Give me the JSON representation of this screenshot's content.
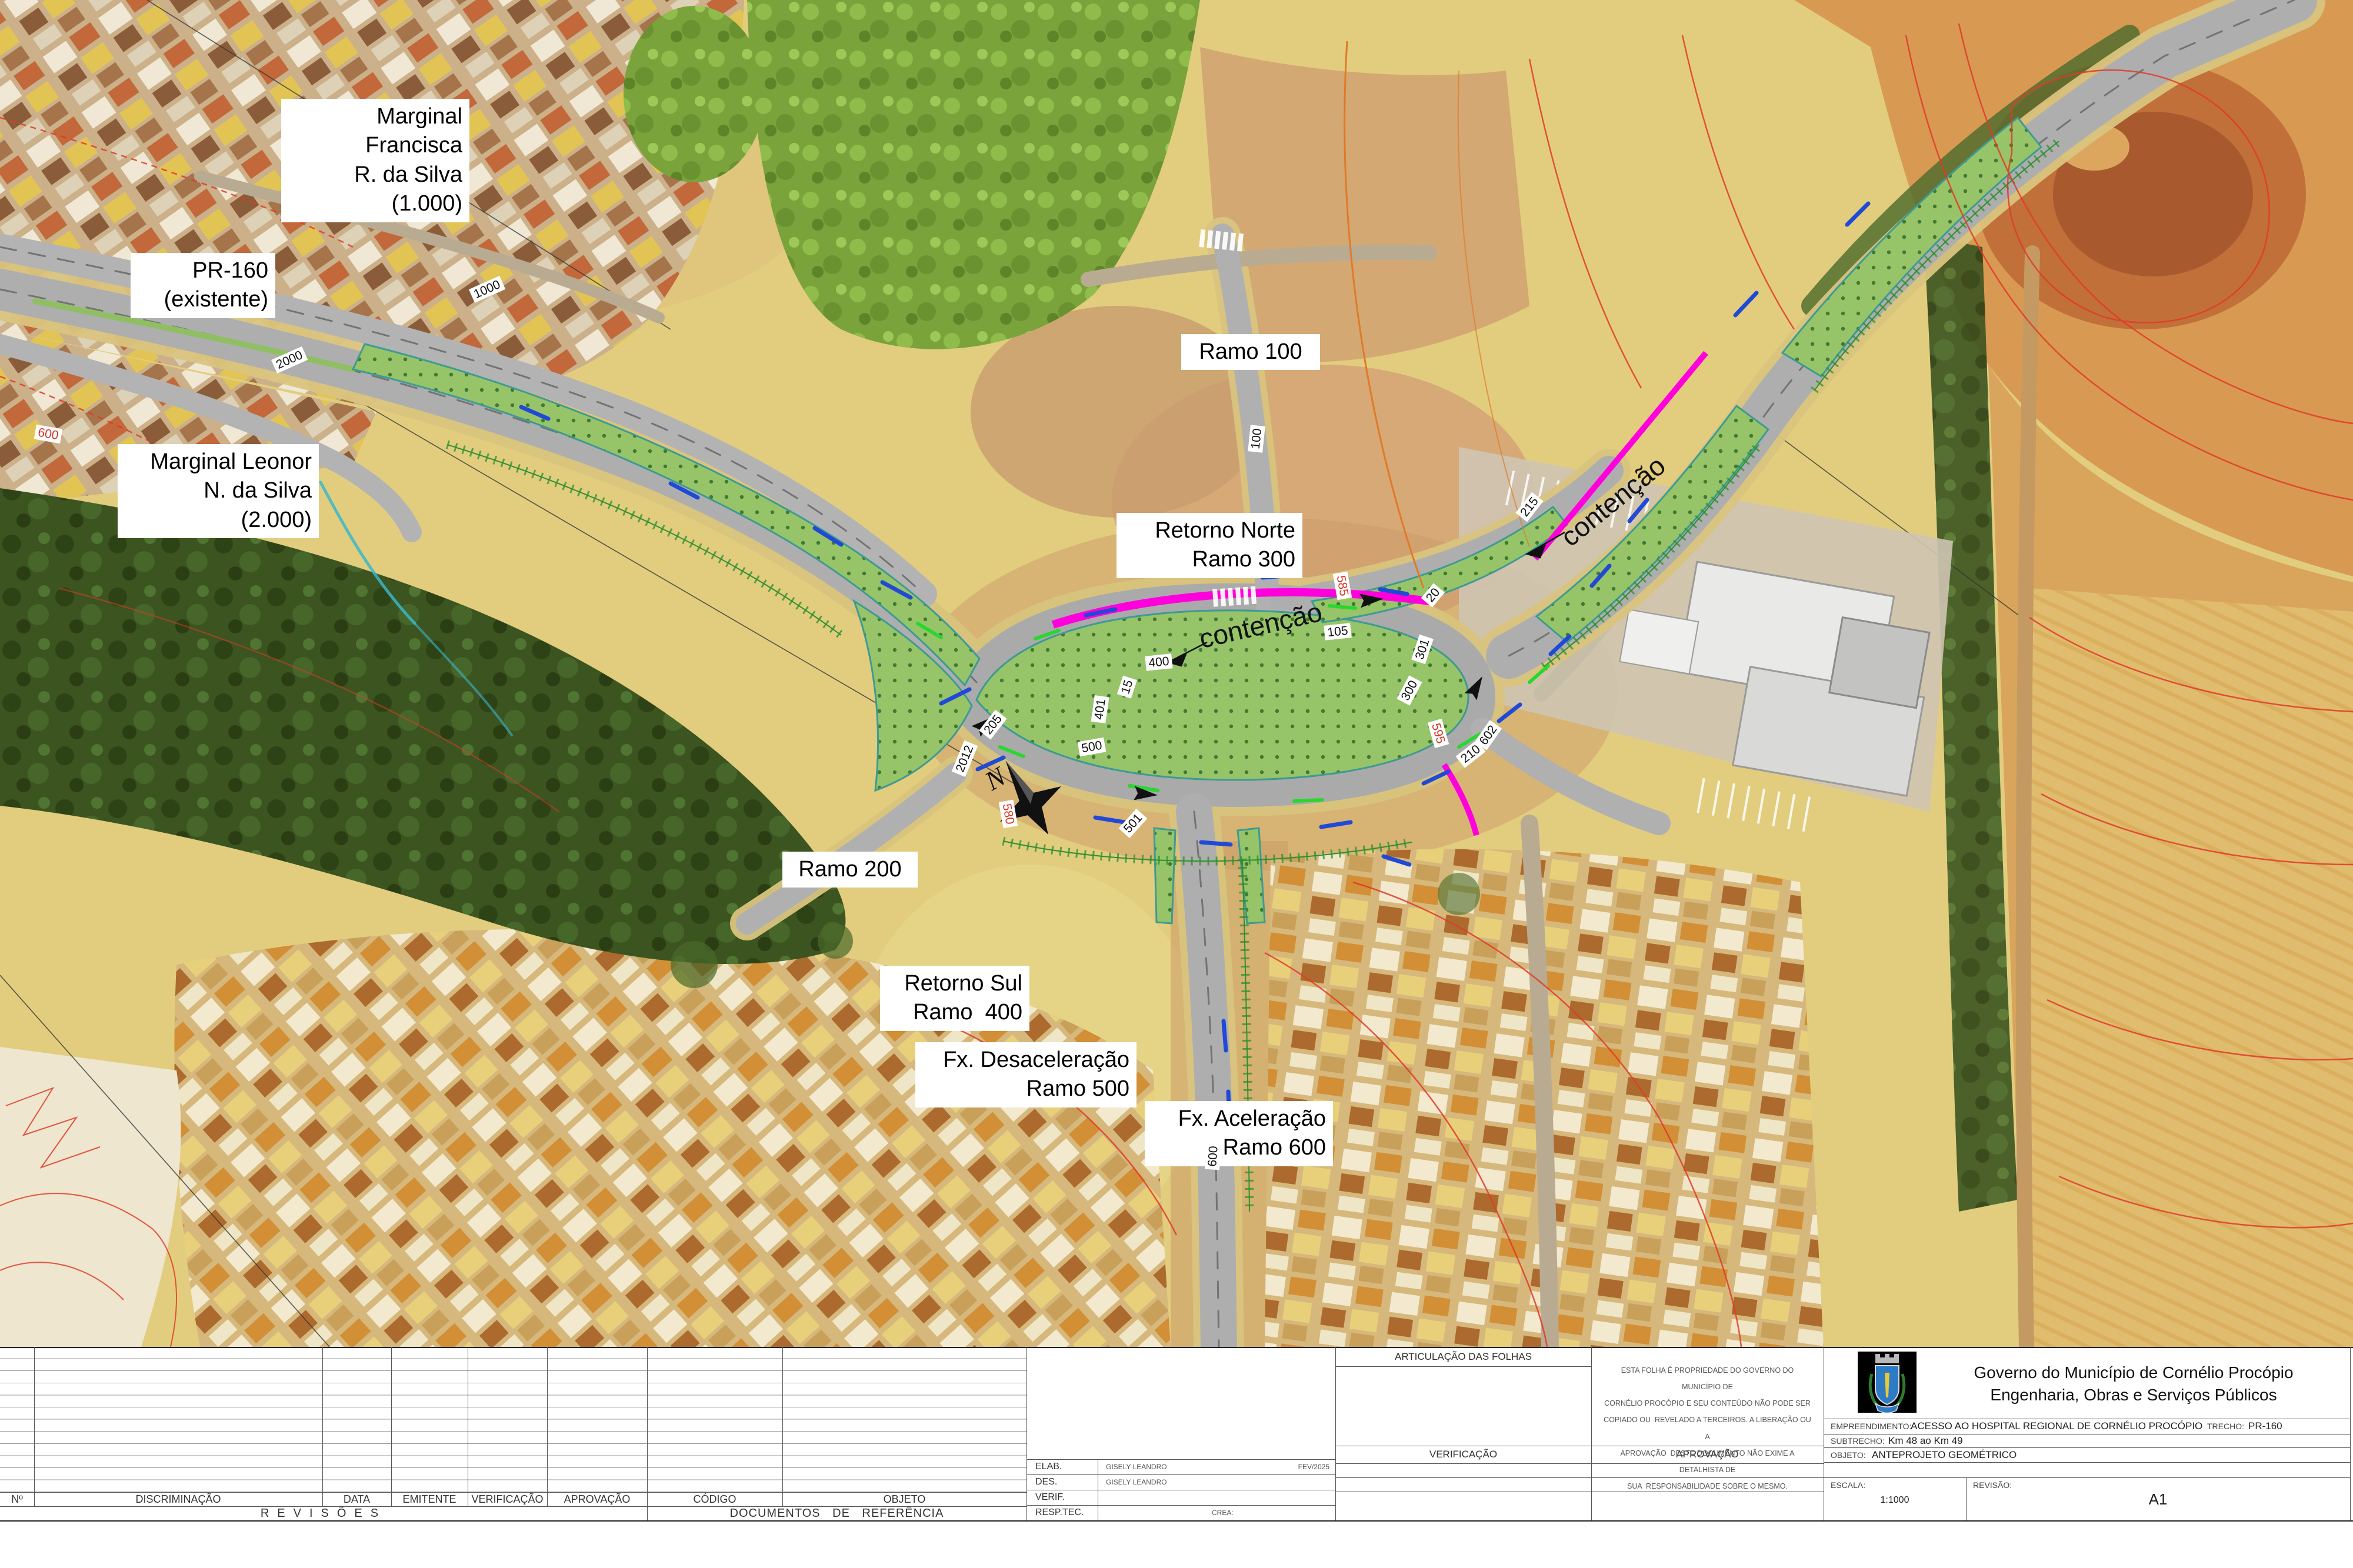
{
  "map": {
    "labels": [
      {
        "text": "Marginal Francisca\nR. da Silva\n(1.000)"
      },
      {
        "text": "PR-160\n(existente)"
      },
      {
        "text": "Marginal Leonor\nN. da Silva\n(2.000)"
      },
      {
        "text": "Ramo 100"
      },
      {
        "text": "Retorno Norte\nRamo 300"
      },
      {
        "text": "Ramo 200"
      },
      {
        "text": "Retorno Sul\nRamo  400"
      },
      {
        "text": "Fx. Desaceleração\nRamo 500"
      },
      {
        "text": "Fx. Aceleração\nRamo 600"
      }
    ],
    "contencao": [
      "contenção",
      "contenção"
    ],
    "north": "N",
    "stations": [
      "1000",
      "2000",
      "2012",
      "205",
      "400",
      "401",
      "15",
      "500",
      "501",
      "105",
      "210",
      "300",
      "301",
      "100",
      "215",
      "600",
      "602",
      "20"
    ],
    "contours": [
      "585",
      "595",
      "580",
      "600"
    ]
  },
  "sheet": {
    "revisions": {
      "headers": [
        "Nº",
        "DISCRIMINAÇÃO",
        "DATA",
        "EMITENTE",
        "VERIFICAÇÃO",
        "APROVAÇÃO"
      ],
      "footer": "REVISÕES"
    },
    "documents": {
      "headers": [
        "CÓDIGO",
        "OBJETO"
      ],
      "footer": "DOCUMENTOS DE REFERÊNCIA"
    },
    "credits": {
      "rows": [
        {
          "label": "ELAB.",
          "value": "GISELY LEANDRO",
          "extra": "FEV/2025"
        },
        {
          "label": "DES.",
          "value": "GISELY LEANDRO",
          "extra": ""
        },
        {
          "label": "VERIF.",
          "value": "",
          "extra": ""
        },
        {
          "label": "RESP.TEC.",
          "value": "",
          "extra": "CREA:"
        }
      ]
    },
    "articulacao_title": "ARTICULAÇÃO DAS FOLHAS",
    "verificacao_label": "VERIFICAÇÃO",
    "aprovacao_label": "APROVAÇÃO",
    "disclaimer": "ESTA FOLHA É PROPRIEDADE DO GOVERNO DO MUNICÍPIO DE\nCORNÉLIO PROCÓPIO E SEU CONTEÚDO NÃO PODE SER\nCOPIADO OU  REVELADO A TERCEIROS. A LIBERAÇÃO OU A\nAPROVAÇÃO  DESTE DOCUMENTO NÃO EXIME A DETALHISTA DE\nSUA  RESPONSABILIDADE SOBRE O MESMO.",
    "titleblock": {
      "org_line1": "Governo do Município de Cornélio Procópio",
      "org_line2": "Engenharia, Obras e Serviços Públicos",
      "empreendimento_label": "EMPREENDIMENTO:",
      "empreendimento": "ACESSO AO HOSPITAL REGIONAL DE CORNÉLIO PROCÓPIO",
      "trecho_label": "TRECHO:",
      "trecho": "PR-160",
      "subtrecho_label": "SUBTRECHO:",
      "subtrecho": "Km 48 ao Km 49",
      "objeto_label": "OBJETO:",
      "objeto": "ANTEPROJETO GEOMÉTRICO",
      "escala_label": "ESCALA:",
      "escala": "1:1000",
      "revisao_label": "REVISÃO:",
      "revisao": "A1"
    }
  },
  "colors": {
    "contencao_magenta": "#ff00dd",
    "contour_red": "#e13a28",
    "island_green": "#97c468",
    "road_gray": "#aeaeae"
  }
}
